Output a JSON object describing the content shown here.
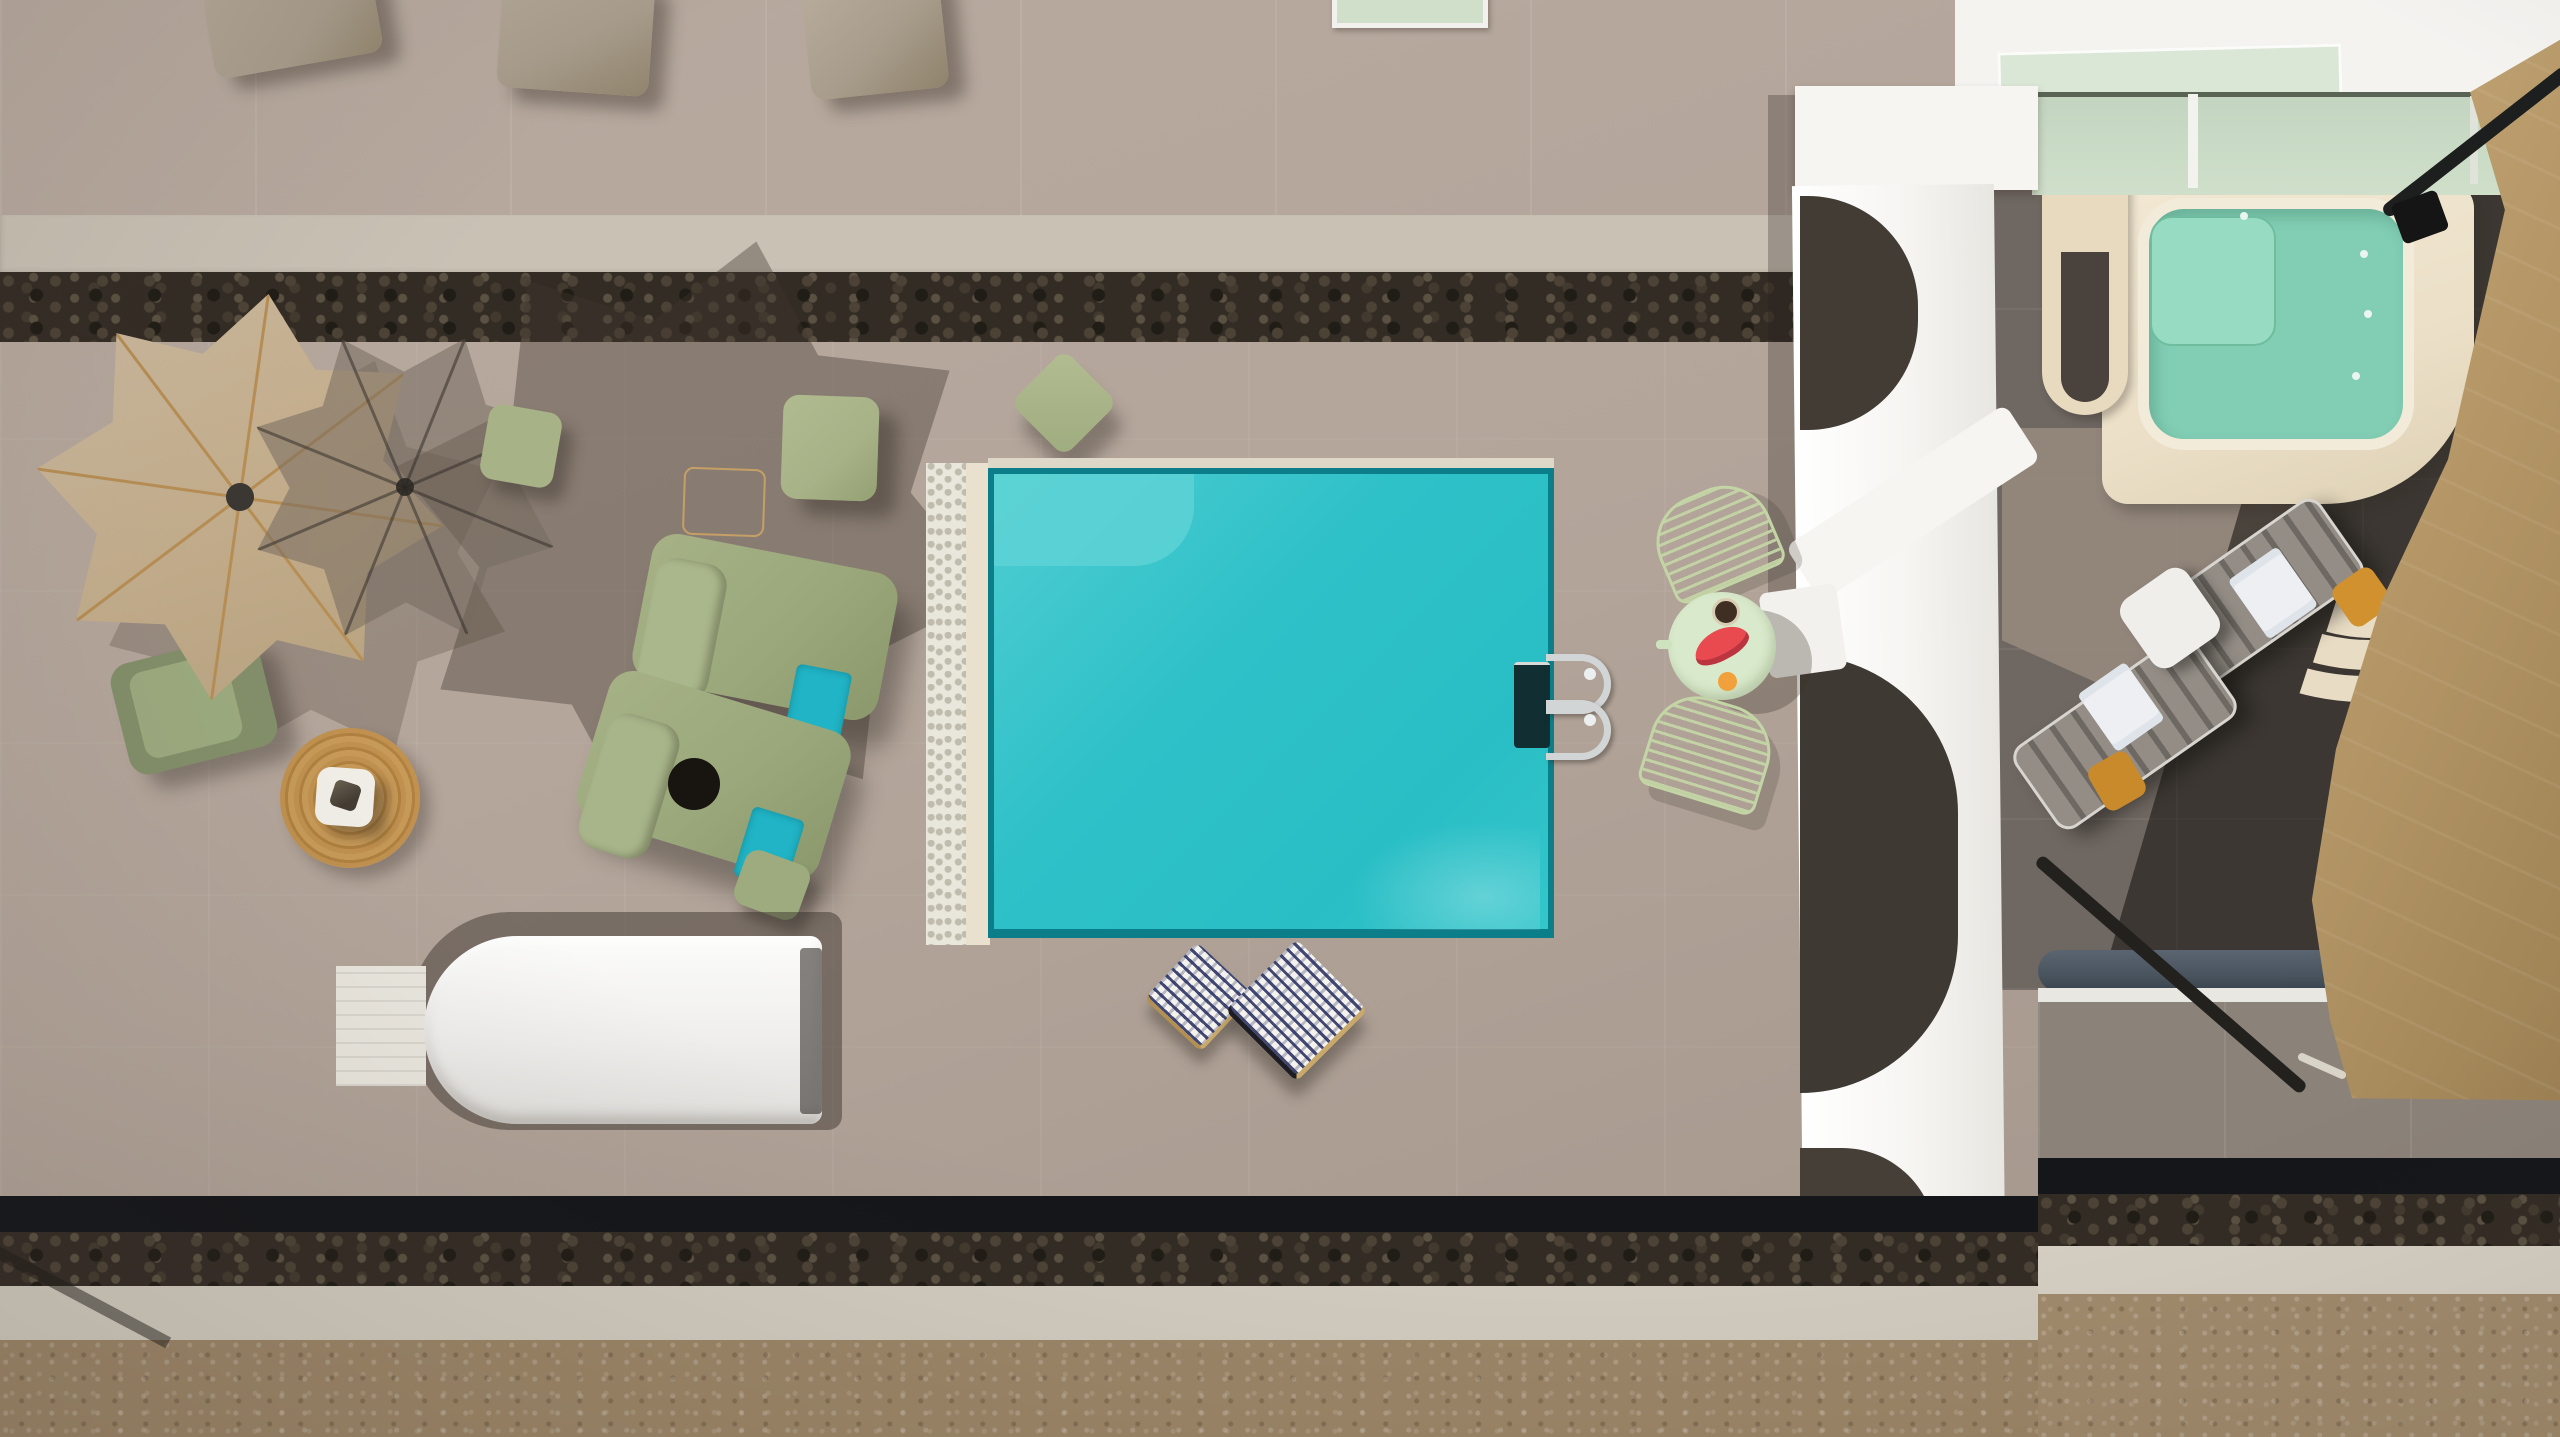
{
  "scene": {
    "type": "aerial-photo",
    "description": "Top-down drone view of a villa pool terrace in afternoon sun",
    "areas": {
      "upper_terrace": "warm gray paved terrace with taupe floor cushions along top edge",
      "stone_wall_top": "dark pebble stone retaining wall strip",
      "main_terrace": "large gray-mauve tiled pool terrace",
      "pool": "rectangular turquoise pool with white pebble border, cream coping and chrome ladder",
      "pergola": "white sculpted colonnade wall with arched openings",
      "jacuzzi_corner": "cream deck with seafoam plunge pool, fan-shaped steps and glass balustrade",
      "shade_sail_zone": "shaded terrace with two gray loungers under a tan shade sail",
      "bottom_edge": "black capped pebble wall, white curb and brown gravel ground"
    },
    "objects": [
      {
        "name": "parasol-beige",
        "desc": "fringed 8-rib beige parasol, top-down"
      },
      {
        "name": "parasol-mesh",
        "desc": "gray translucent mesh parasol overlapping the beige one"
      },
      {
        "name": "parasol-shadow",
        "desc": "large star-shaped umbrella shadow on paving"
      },
      {
        "name": "armchair-olive",
        "desc": "olive green lounge chair"
      },
      {
        "name": "jute-rug",
        "desc": "round woven jute rug with white side table and dark glass lantern"
      },
      {
        "name": "lounger-olive-1",
        "desc": "sage padded sun lounger with rolled headrest and teal towel"
      },
      {
        "name": "lounger-olive-2",
        "desc": "sage padded sun lounger with black sun hat and teal towel"
      },
      {
        "name": "pouf-sage-small",
        "desc": "small sage square pouf"
      },
      {
        "name": "pouf-sage-large",
        "desc": "large sage square pouf"
      },
      {
        "name": "pouf-sage-diagonal",
        "desc": "sage cushion set diagonally near pool corner"
      },
      {
        "name": "pouf-sage-foot",
        "desc": "sage pouf at lounger foot"
      },
      {
        "name": "paving-outline",
        "desc": "thin tan square outline in paving"
      },
      {
        "name": "daybed-cocoon-white",
        "desc": "large white curved daybed cocoon with striped mat"
      },
      {
        "name": "cushion-pattern-1",
        "desc": "navy-white geometric cushion, diamond orientation"
      },
      {
        "name": "cushion-pattern-2",
        "desc": "navy-white geometric cushion, diamond orientation"
      },
      {
        "name": "pool-ladder",
        "desc": "chrome pool ladder with two curved handrails"
      },
      {
        "name": "side-table-mint",
        "desc": "round mint table with watermelon slice, bowl and orange"
      },
      {
        "name": "wire-chair-1",
        "desc": "pale green wire chair"
      },
      {
        "name": "wire-chair-2",
        "desc": "pale green wire chair"
      },
      {
        "name": "lounger-gray-1",
        "desc": "gray slatted lounger with white towel"
      },
      {
        "name": "lounger-gray-2",
        "desc": "gray slatted lounger with white towel"
      },
      {
        "name": "side-table-white",
        "desc": "white side table between gray loungers"
      },
      {
        "name": "cushion-orange-1",
        "desc": "ochre cushion"
      },
      {
        "name": "cushion-orange-2",
        "desc": "ochre cushion"
      },
      {
        "name": "shade-sail",
        "desc": "tan triangular shade sail with black poles and rigging"
      },
      {
        "name": "jacuzzi",
        "desc": "seafoam plunge pool with inner bench and cream rim"
      },
      {
        "name": "glass-balustrade",
        "desc": "green-tinted glass railing on white wall"
      },
      {
        "name": "skylight",
        "desc": "white framed skylight at top edge"
      },
      {
        "name": "taupe-cushions-top",
        "desc": "three taupe cushions cut by top edge"
      },
      {
        "name": "handrail-tube",
        "desc": "blue-gray tubular rail at lower right"
      }
    ]
  },
  "palette": {
    "terrace_main": "#b3a59a",
    "upper_terrace": "#bcaea2",
    "curb_light": "#c9c1b4",
    "stone_dark": "#332c25",
    "black_band": "#14161a",
    "curb_white": "#d2ccc0",
    "gravel": "#9c8668",
    "pool_water": "#2fc1c8",
    "pool_water_light": "#5ed2d5",
    "pool_rim": "#0b7e89",
    "pebble_white": "#e9e6db",
    "pool_cream": "#e9e1cd",
    "olive": "#9aa87b",
    "sage": "#a7b287",
    "teal_towel": "#20b4c6",
    "mint_table": "#d9e9cb",
    "wire_chair": "#c3d5a5",
    "watermelon": "#e84a50",
    "orange_fruit": "#f0a13c",
    "jute": "#c0914f",
    "pergola_white": "#f6f5f2",
    "shade_terrace": "#6f6761",
    "sail_tan": "#b69868",
    "jacuzzi_water": "#82ceb4",
    "jacuzzi_bench": "#97dbc2",
    "deck_cream": "#ebdfc7",
    "glass_green": "#cfdfca",
    "tube_blue": "#49545f",
    "gray_lounger_dark": "#6d6862",
    "cushion_orange": "#d2912f",
    "taupe_cushion": "#a89d8c"
  }
}
